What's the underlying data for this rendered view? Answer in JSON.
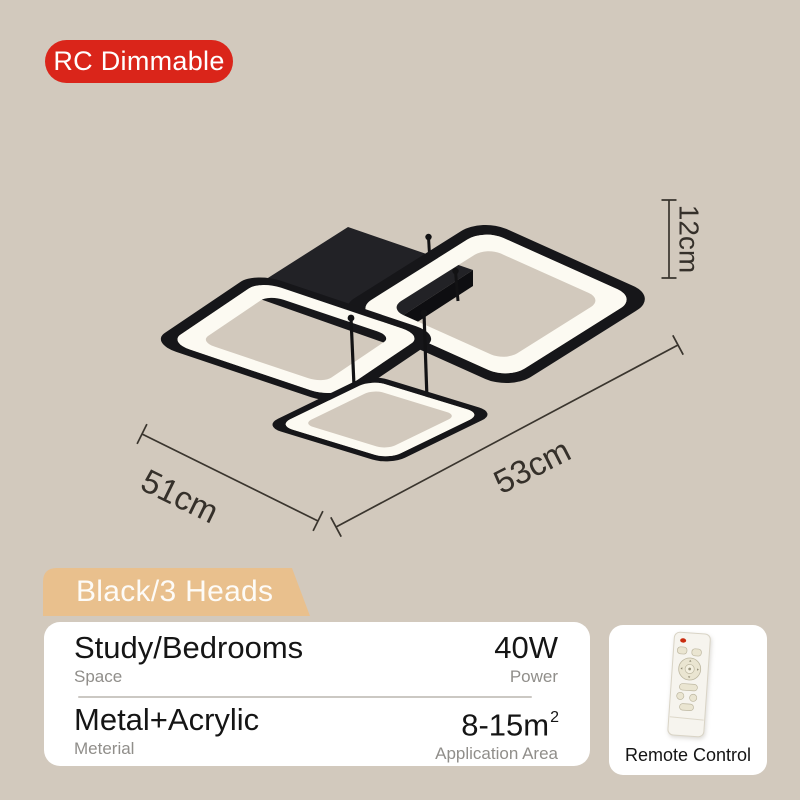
{
  "top_badge": {
    "label": "RC Dimmable"
  },
  "lamp": {
    "dim_height": "12cm",
    "dim_left": "51cm",
    "dim_right": "53cm"
  },
  "variant_badge": {
    "label": "Black/3 Heads"
  },
  "spec_card": {
    "rows": [
      {
        "left_value": "Study/Bedrooms",
        "left_label": "Space",
        "right_value": "40W",
        "right_label": "Power"
      },
      {
        "left_value": "Metal+Acrylic",
        "left_label": "Meterial",
        "right_value": "8-15m",
        "right_sup": "2",
        "right_label": "Application Area"
      }
    ]
  },
  "remote_card": {
    "label": "Remote Control"
  },
  "colors": {
    "background": "#d2c9bd",
    "badge_red": "#da251a",
    "badge_tan": "#e9c08d",
    "card_white": "#ffffff",
    "text_dark": "#151515",
    "text_gray": "#908e8a",
    "dimension_ink": "#3a352e",
    "lamp_black": "#161619",
    "led_white": "#fcfaf2"
  }
}
